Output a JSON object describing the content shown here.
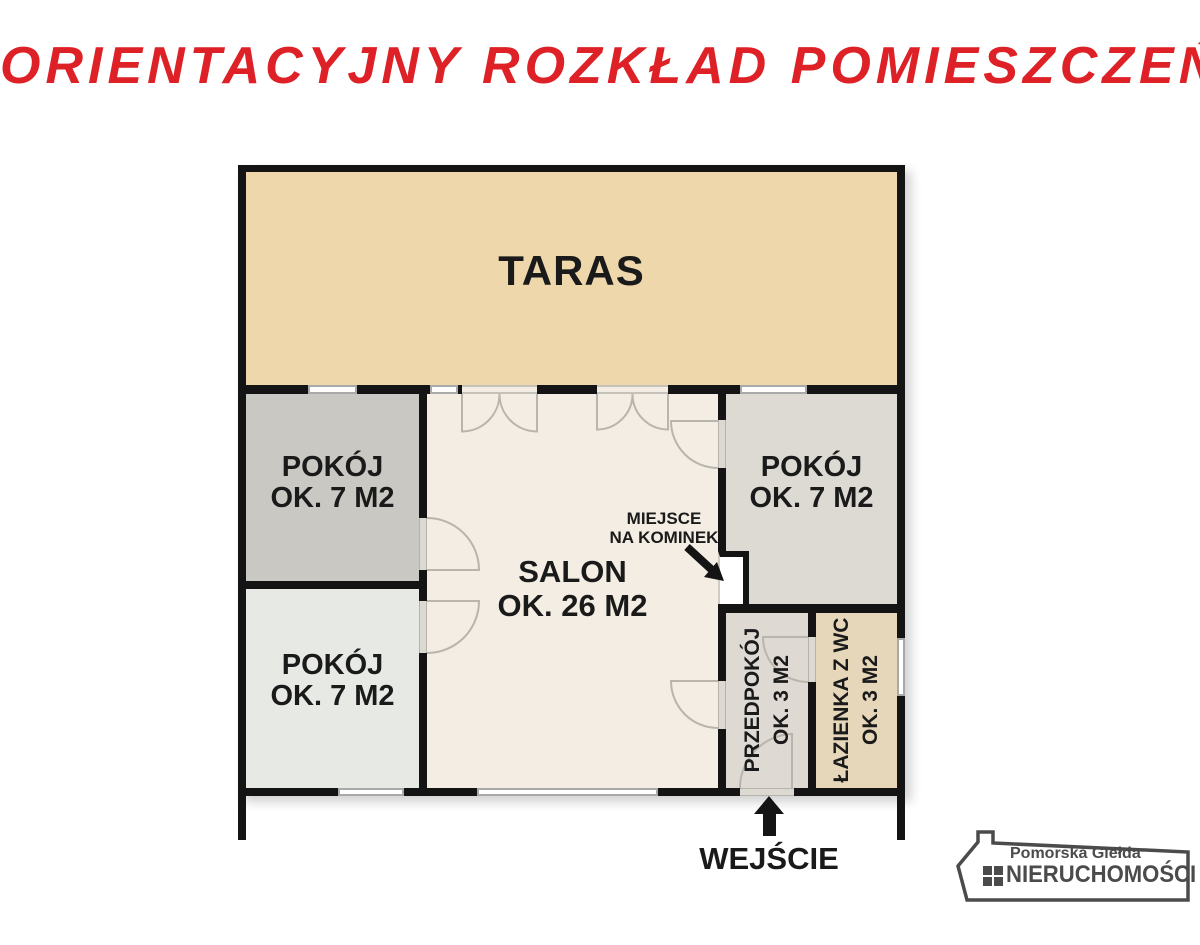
{
  "title": "ORIENTACYJNY ROZKŁAD POMIESZCZEŃ",
  "colors": {
    "wall": "#141414",
    "title": "#dd2127",
    "label": "#1a1a1a",
    "taras": "#eed7ab",
    "pokoj_a": "#c9c8c3",
    "pokoj_b": "#e7e9e5",
    "pokoj_c": "#dcdad3",
    "salon": "#f3ede3",
    "przedpokoj": "#ded9d3",
    "lazienka": "#e7d7ba",
    "door_arc": "#b9b5ac",
    "logo_gray": "#4b4b4b"
  },
  "rooms": {
    "taras": {
      "name": "TARAS"
    },
    "pokoj_tl": {
      "name": "POKÓJ",
      "area": "OK. 7 M2"
    },
    "pokoj_bl": {
      "name": "POKÓJ",
      "area": "OK. 7 M2"
    },
    "pokoj_r": {
      "name": "POKÓJ",
      "area": "OK. 7 M2"
    },
    "salon": {
      "name": "SALON",
      "area": "OK. 26 M2"
    },
    "przedpokoj": {
      "name": "PRZEDPOKÓJ",
      "area": "OK. 3 M2"
    },
    "lazienka": {
      "name": "ŁAZIENKA Z WC",
      "area": "OK. 3 M2"
    }
  },
  "annotations": {
    "fireplace_line1": "MIEJSCE",
    "fireplace_line2": "NA KOMINEK",
    "entrance": "WEJŚCIE"
  },
  "logo": {
    "top": "Pomorska Giełda",
    "bottom": "NIERUCHOMOŚCI"
  }
}
